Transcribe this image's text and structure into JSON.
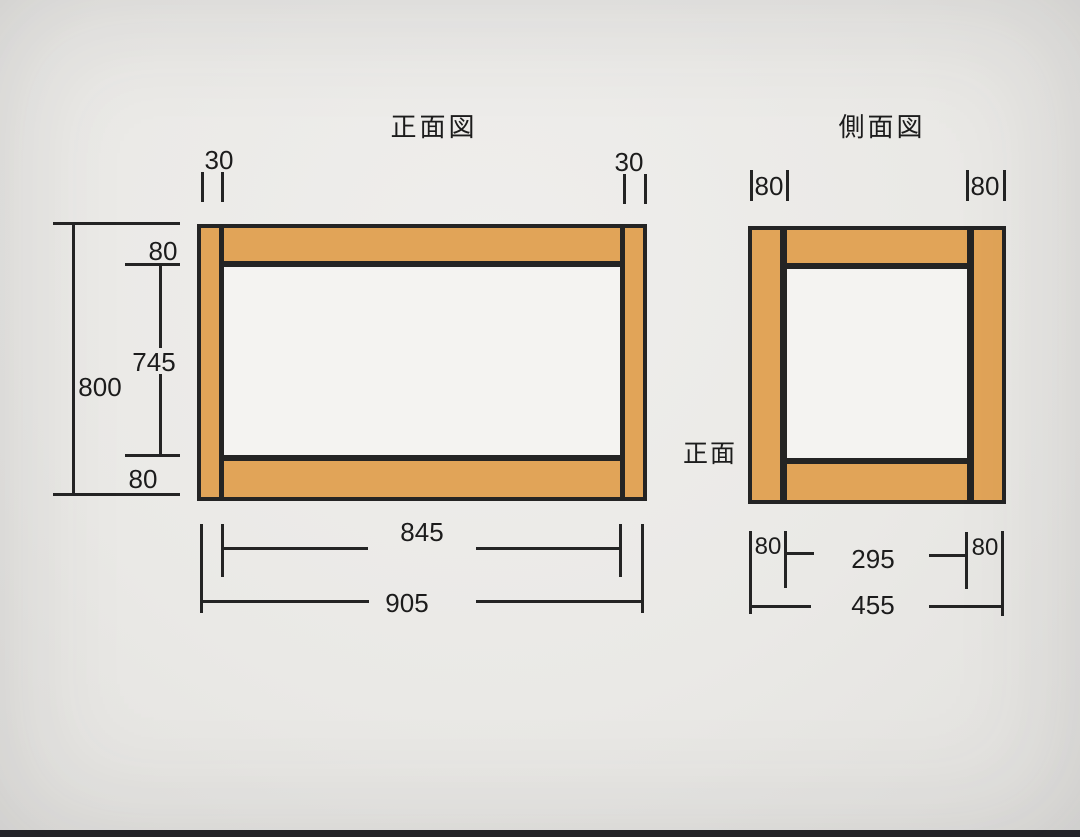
{
  "colors": {
    "wood": "#e1a458",
    "line": "#242424",
    "paper": "#efeeec",
    "paper_edge": "#e2e1de",
    "opening": "#f4f3f1",
    "photo_edge": "#232327"
  },
  "front_view": {
    "title": "正面図",
    "dim_leg_width_left": "30",
    "dim_leg_width_right": "30",
    "dim_overall_height": "800",
    "dim_top_rail_height": "80",
    "dim_opening_height": "745",
    "dim_bottom_rail_height": "80",
    "dim_opening_width": "845",
    "dim_overall_width": "905"
  },
  "side_view": {
    "title": "側面図",
    "orientation_label": "正面",
    "dim_leg_depth_left_top": "80",
    "dim_leg_depth_right_top": "80",
    "dim_leg_depth_left_bottom": "80",
    "dim_opening_depth": "295",
    "dim_leg_depth_right_bottom": "80",
    "dim_overall_depth": "455"
  }
}
